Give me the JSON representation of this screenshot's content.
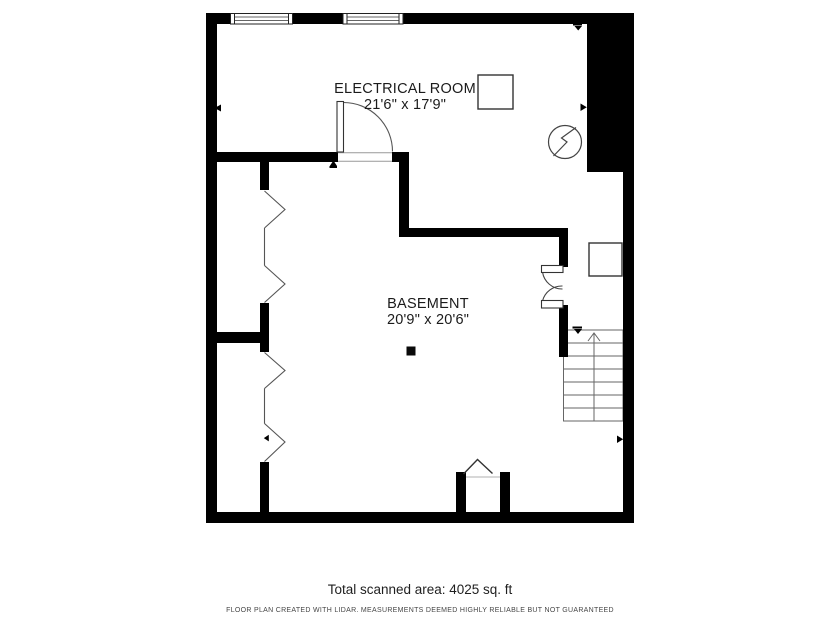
{
  "rooms": [
    {
      "label": "ELECTRICAL ROOM",
      "dimensions": "21'6\" x 17'9\""
    },
    {
      "label": "BASEMENT",
      "dimensions": "20'9\" x 20'6\""
    }
  ],
  "footer": {
    "total_area": "Total scanned area: 4025 sq. ft",
    "disclaimer": "FLOOR PLAN CREATED WITH LIDAR. MEASUREMENTS DEEMED HIGHLY RELIABLE BUT NOT GUARANTEED"
  },
  "colors": {
    "wall": "#000000",
    "thin_line": "#555555",
    "stair_line": "#666666",
    "background": "#ffffff"
  }
}
